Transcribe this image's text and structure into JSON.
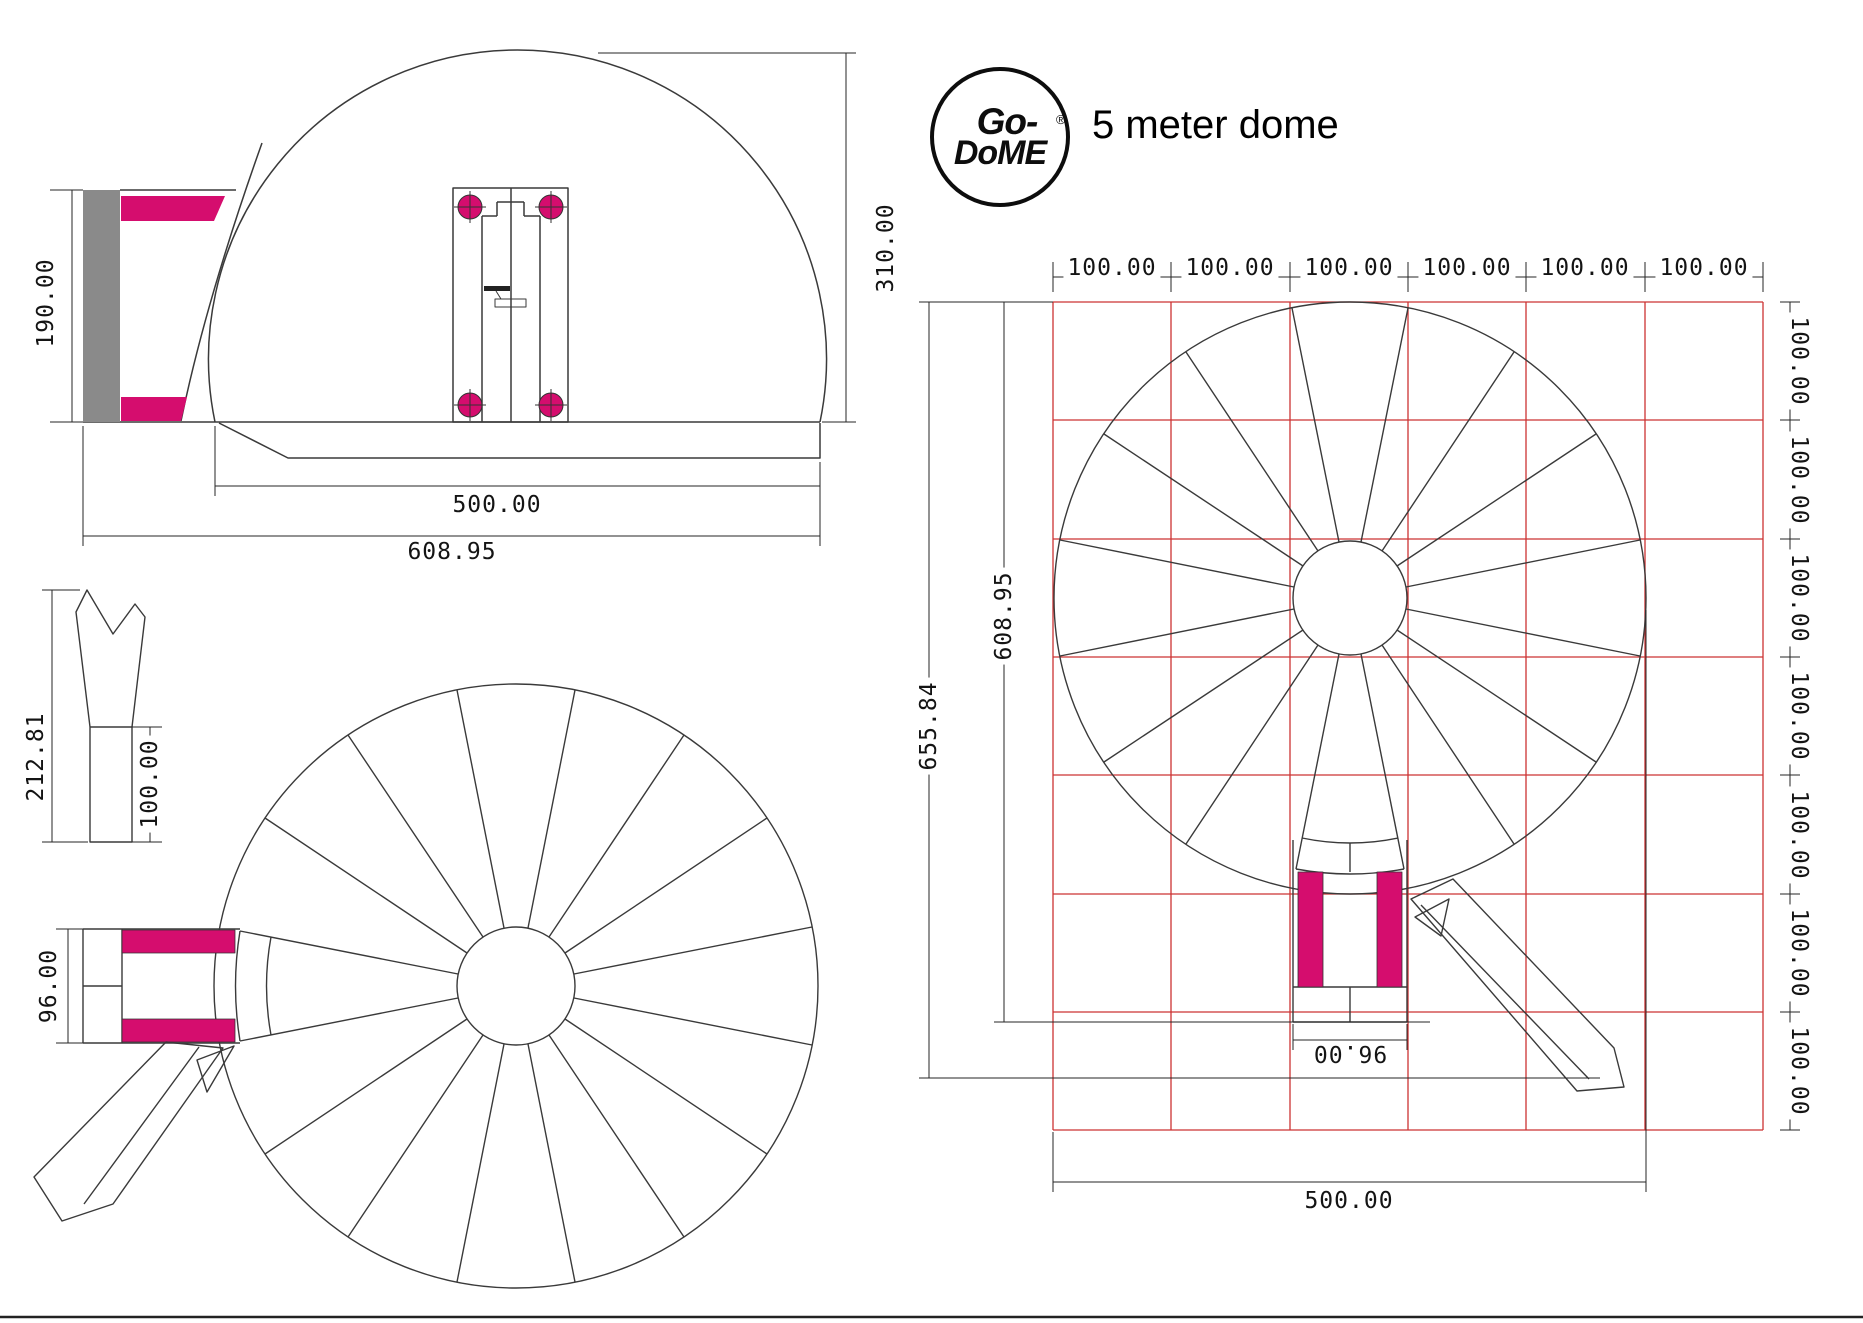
{
  "page": {
    "title_text": "5 meter dome"
  },
  "logo": {
    "line1": "Go-",
    "line2": "DoME",
    "registered": "®"
  },
  "colors": {
    "magenta": "#d50d6e",
    "gray": "#8a8a8a",
    "grid_red": "#cc3333",
    "line_dark": "#3a3a3a"
  },
  "side_view": {
    "dims": {
      "tunnel_height": "190.00",
      "total_height": "310.00",
      "dome_width": "500.00",
      "total_width": "608.95"
    }
  },
  "gore_panel": {
    "dims": {
      "total_length": "212.81",
      "skirt_length": "100.00"
    }
  },
  "plan_view": {
    "dims": {
      "tunnel_width": "96.00"
    }
  },
  "grid_view": {
    "top_dims": [
      "100.00",
      "100.00",
      "100.00",
      "100.00",
      "100.00",
      "100.00"
    ],
    "right_dims": [
      "100.00",
      "100.00",
      "100.00",
      "100.00",
      "100.00",
      "100.00",
      "100.00"
    ],
    "dims": {
      "overall_height": "655.84",
      "dome_and_tunnel_height": "608.95",
      "dome_width": "500.00",
      "tunnel_width": "96.00"
    }
  }
}
